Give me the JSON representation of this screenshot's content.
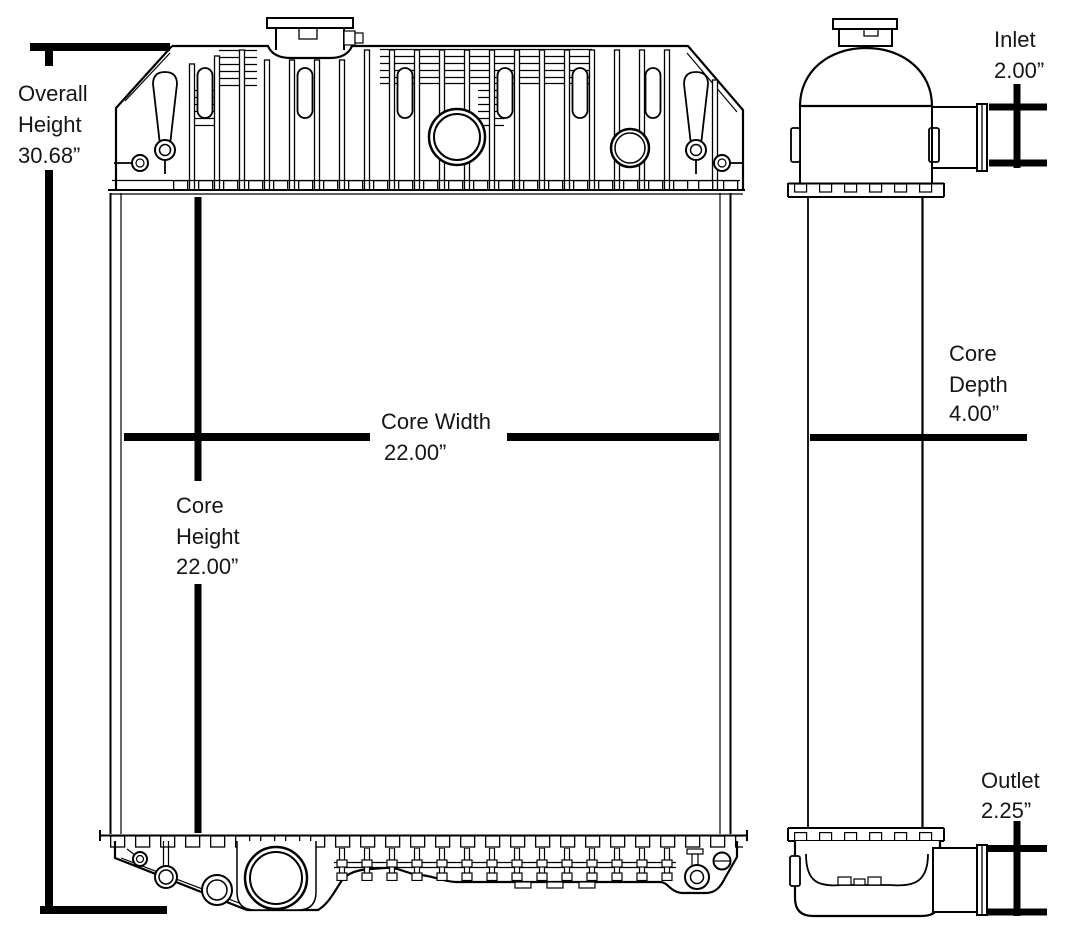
{
  "figure": {
    "type": "technical-dimension-drawing",
    "subject": "radiator",
    "views": [
      "front",
      "side"
    ]
  },
  "colors": {
    "ink": "#000000",
    "dimension_lines": "#000000",
    "text": "#161616",
    "background": "#ffffff"
  },
  "dimensions": {
    "overall_height": {
      "l1": "Overall",
      "l2": "Height",
      "value": "30.68”"
    },
    "core_width": {
      "l1": "Core Width",
      "value": "22.00”"
    },
    "core_height": {
      "l1": "Core",
      "l2": "Height",
      "value": "22.00”"
    },
    "inlet": {
      "l1": "Inlet",
      "value": "2.00”"
    },
    "core_depth": {
      "l1": "Core",
      "l2": "Depth",
      "value": "4.00”"
    },
    "outlet": {
      "l1": "Outlet",
      "value": "2.25”"
    }
  }
}
